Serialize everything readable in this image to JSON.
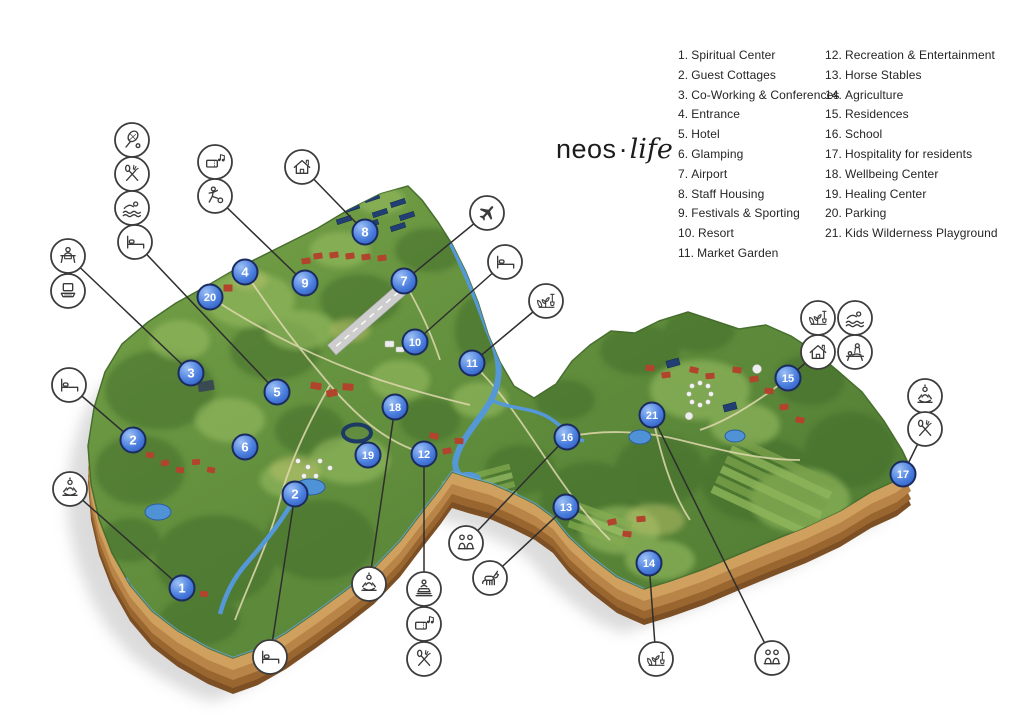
{
  "logo": {
    "brand": "neos",
    "separator": "·",
    "suffix": "life"
  },
  "legend": {
    "col1": [
      {
        "num": "1.",
        "label": "Spiritual Center"
      },
      {
        "num": "2.",
        "label": "Guest Cottages"
      },
      {
        "num": "3.",
        "label": "Co-Working & Conferences"
      },
      {
        "num": "4.",
        "label": "Entrance"
      },
      {
        "num": "5.",
        "label": "Hotel"
      },
      {
        "num": "6.",
        "label": "Glamping"
      },
      {
        "num": "7.",
        "label": "Airport"
      },
      {
        "num": "8.",
        "label": "Staff Housing"
      },
      {
        "num": "9.",
        "label": "Festivals & Sporting"
      },
      {
        "num": "10.",
        "label": "Resort"
      },
      {
        "num": "11.",
        "label": "Market Garden"
      }
    ],
    "col2": [
      {
        "num": "12.",
        "label": "Recreation & Entertainment"
      },
      {
        "num": "13.",
        "label": "Horse Stables"
      },
      {
        "num": "14.",
        "label": "Agriculture"
      },
      {
        "num": "15.",
        "label": "Residences"
      },
      {
        "num": "16.",
        "label": "School"
      },
      {
        "num": "17.",
        "label": "Hospitality for residents"
      },
      {
        "num": "18.",
        "label": "Wellbeing Center"
      },
      {
        "num": "19.",
        "label": "Healing Center"
      },
      {
        "num": "20.",
        "label": "Parking"
      },
      {
        "num": "21.",
        "label": "Kids Wilderness Playground"
      }
    ]
  },
  "colors": {
    "marker_blue": "#3f6fd1",
    "marker_ring": "#1b2b60",
    "icon_ring": "#3c3c3c",
    "terrain_green": "#5d8a3a",
    "soil_brown": "#b98447",
    "water_blue": "#5598d8"
  },
  "map": {
    "markers": [
      {
        "label": "1",
        "x": 182,
        "y": 588
      },
      {
        "label": "2",
        "x": 133,
        "y": 440
      },
      {
        "label": "2",
        "x": 295,
        "y": 494
      },
      {
        "label": "3",
        "x": 191,
        "y": 373
      },
      {
        "label": "4",
        "x": 245,
        "y": 272
      },
      {
        "label": "5",
        "x": 277,
        "y": 392
      },
      {
        "label": "6",
        "x": 245,
        "y": 447
      },
      {
        "label": "7",
        "x": 404,
        "y": 281
      },
      {
        "label": "8",
        "x": 365,
        "y": 232
      },
      {
        "label": "9",
        "x": 305,
        "y": 283
      },
      {
        "label": "10",
        "x": 415,
        "y": 342
      },
      {
        "label": "11",
        "x": 472,
        "y": 363
      },
      {
        "label": "12",
        "x": 424,
        "y": 454
      },
      {
        "label": "13",
        "x": 566,
        "y": 507
      },
      {
        "label": "14",
        "x": 649,
        "y": 563
      },
      {
        "label": "15",
        "x": 788,
        "y": 378
      },
      {
        "label": "16",
        "x": 567,
        "y": 437
      },
      {
        "label": "17",
        "x": 903,
        "y": 474
      },
      {
        "label": "18",
        "x": 395,
        "y": 407
      },
      {
        "label": "19",
        "x": 368,
        "y": 455
      },
      {
        "label": "20",
        "x": 210,
        "y": 297
      },
      {
        "label": "21",
        "x": 652,
        "y": 415
      }
    ],
    "icons": [
      {
        "glyph": "tennis",
        "x": 132,
        "y": 140
      },
      {
        "glyph": "dining",
        "x": 132,
        "y": 174
      },
      {
        "glyph": "swimming",
        "x": 132,
        "y": 208
      },
      {
        "glyph": "bed",
        "x": 135,
        "y": 242
      },
      {
        "glyph": "reception",
        "x": 68,
        "y": 256
      },
      {
        "glyph": "laptop",
        "x": 68,
        "y": 291
      },
      {
        "glyph": "festival",
        "x": 215,
        "y": 162
      },
      {
        "glyph": "soccer",
        "x": 215,
        "y": 196
      },
      {
        "glyph": "house",
        "x": 302,
        "y": 167
      },
      {
        "glyph": "airplane",
        "x": 487,
        "y": 213
      },
      {
        "glyph": "bed",
        "x": 505,
        "y": 262
      },
      {
        "glyph": "garden",
        "x": 546,
        "y": 301
      },
      {
        "glyph": "bed",
        "x": 69,
        "y": 385
      },
      {
        "glyph": "meditation",
        "x": 70,
        "y": 489
      },
      {
        "glyph": "bed",
        "x": 270,
        "y": 657
      },
      {
        "glyph": "meditation",
        "x": 369,
        "y": 584
      },
      {
        "glyph": "statue",
        "x": 424,
        "y": 589
      },
      {
        "glyph": "festival",
        "x": 424,
        "y": 624
      },
      {
        "glyph": "dining",
        "x": 424,
        "y": 659
      },
      {
        "glyph": "kids",
        "x": 466,
        "y": 543
      },
      {
        "glyph": "horse",
        "x": 490,
        "y": 578
      },
      {
        "glyph": "garden",
        "x": 818,
        "y": 318
      },
      {
        "glyph": "swimming",
        "x": 855,
        "y": 318
      },
      {
        "glyph": "house",
        "x": 818,
        "y": 352
      },
      {
        "glyph": "massage",
        "x": 855,
        "y": 352
      },
      {
        "glyph": "meditation",
        "x": 925,
        "y": 396
      },
      {
        "glyph": "dining",
        "x": 925,
        "y": 429
      },
      {
        "glyph": "garden",
        "x": 656,
        "y": 659
      },
      {
        "glyph": "kids",
        "x": 772,
        "y": 658
      }
    ],
    "connectors": [
      {
        "x1": 135,
        "y1": 242,
        "x2": 277,
        "y2": 392
      },
      {
        "x1": 70,
        "y1": 258,
        "x2": 191,
        "y2": 373
      },
      {
        "x1": 215,
        "y1": 196,
        "x2": 305,
        "y2": 283
      },
      {
        "x1": 302,
        "y1": 167,
        "x2": 365,
        "y2": 232
      },
      {
        "x1": 487,
        "y1": 213,
        "x2": 404,
        "y2": 281
      },
      {
        "x1": 505,
        "y1": 262,
        "x2": 415,
        "y2": 342
      },
      {
        "x1": 546,
        "y1": 301,
        "x2": 472,
        "y2": 363
      },
      {
        "x1": 69,
        "y1": 385,
        "x2": 133,
        "y2": 440
      },
      {
        "x1": 70,
        "y1": 489,
        "x2": 182,
        "y2": 588
      },
      {
        "x1": 270,
        "y1": 657,
        "x2": 295,
        "y2": 494
      },
      {
        "x1": 369,
        "y1": 584,
        "x2": 395,
        "y2": 407
      },
      {
        "x1": 424,
        "y1": 589,
        "x2": 424,
        "y2": 454
      },
      {
        "x1": 466,
        "y1": 543,
        "x2": 567,
        "y2": 437
      },
      {
        "x1": 490,
        "y1": 578,
        "x2": 566,
        "y2": 507
      },
      {
        "x1": 818,
        "y1": 352,
        "x2": 788,
        "y2": 378
      },
      {
        "x1": 925,
        "y1": 429,
        "x2": 903,
        "y2": 474
      },
      {
        "x1": 656,
        "y1": 659,
        "x2": 649,
        "y2": 563
      },
      {
        "x1": 772,
        "y1": 658,
        "x2": 652,
        "y2": 415
      }
    ]
  }
}
